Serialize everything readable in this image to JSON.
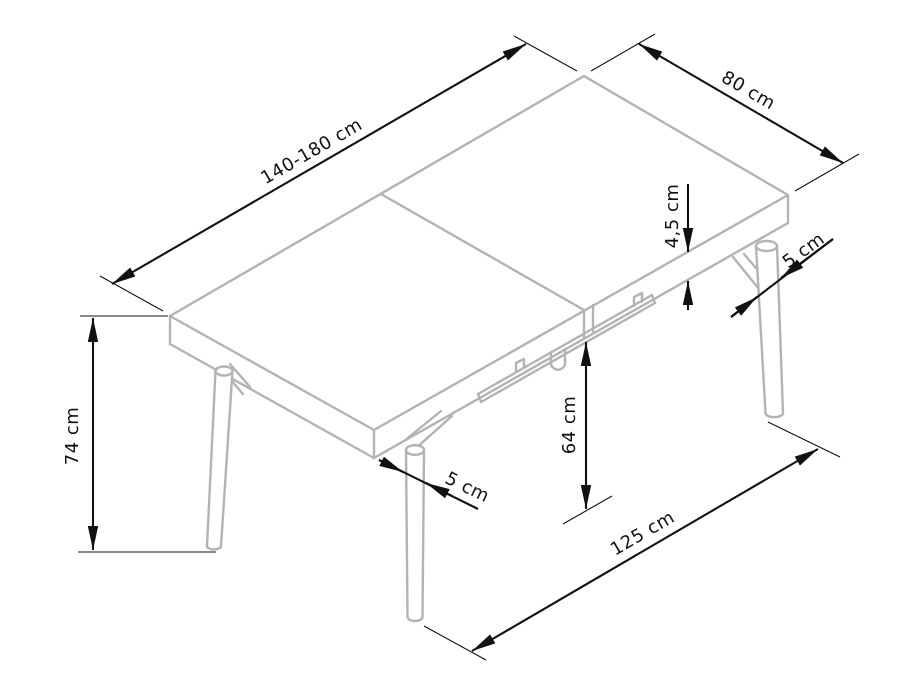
{
  "drawing": {
    "subject": "extendable-table-dimension-drawing",
    "background_color": "#ffffff",
    "furniture_line_color": "#b3b3b3",
    "dimension_color": "#111111",
    "dims": {
      "length": {
        "label": "140-180 cm",
        "measures": "table top length (extendable)"
      },
      "width": {
        "label": "80 cm",
        "measures": "table top width"
      },
      "thickness": {
        "label": "4,5 cm",
        "measures": "table top thickness"
      },
      "leg_right": {
        "label": "5 cm",
        "measures": "right leg diameter"
      },
      "height": {
        "label": "74 cm",
        "measures": "overall table height"
      },
      "clearance": {
        "label": "64 cm",
        "measures": "clearance under apron"
      },
      "leg_front": {
        "label": "5 cm",
        "measures": "front leg diameter"
      },
      "leg_span": {
        "label": "125 cm",
        "measures": "distance between legs"
      }
    }
  }
}
